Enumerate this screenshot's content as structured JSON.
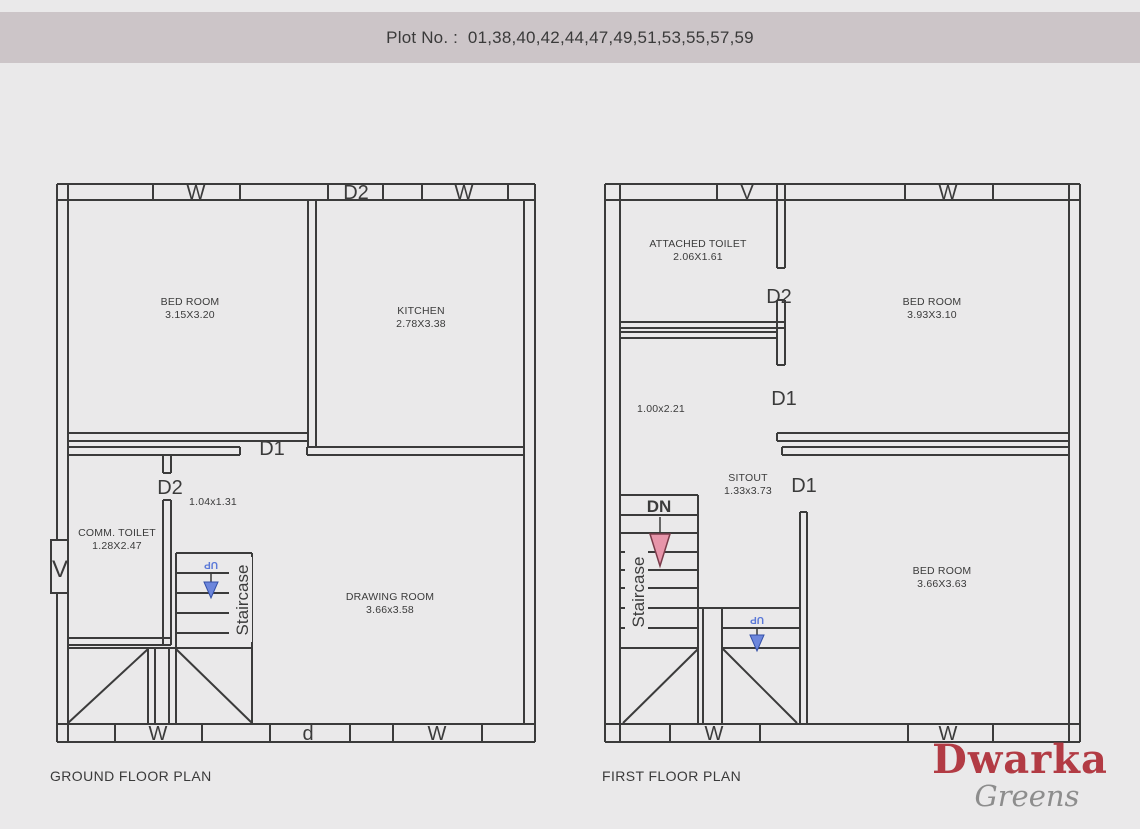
{
  "header": {
    "title": "Plot No. :  01,38,40,42,44,47,49,51,53,55,57,59"
  },
  "colors": {
    "background": "#eae9ea",
    "header_bar": "#ccc5c8",
    "wall_line": "#3b3b3b",
    "up_arrow_blue": "#5b79d8",
    "dn_arrow_pink": "#e795aa",
    "logo_red": "#b23b44",
    "logo_gray": "#8d8d8d"
  },
  "ground_floor": {
    "title": "GROUND FLOOR PLAN",
    "top_openings": [
      "W",
      "D2",
      "W"
    ],
    "bottom_openings": [
      "W",
      "d",
      "W"
    ],
    "left_opening": "V",
    "door_d1": "D1",
    "door_d2": "D2",
    "passage_dim": "1.04x1.31",
    "rooms": {
      "bedroom": {
        "name": "BED ROOM",
        "dim": "3.15X3.20"
      },
      "kitchen": {
        "name": "KITCHEN",
        "dim": "2.78X3.38"
      },
      "toilet": {
        "name": "COMM. TOILET",
        "dim": "1.28X2.47"
      },
      "drawing": {
        "name": "DRAWING ROOM",
        "dim": "3.66x3.58"
      }
    },
    "staircase": {
      "label": "Staircase",
      "up": "UP"
    }
  },
  "first_floor": {
    "title": "FIRST FLOOR PLAN",
    "top_openings": [
      "V",
      "W"
    ],
    "bottom_openings": [
      "W",
      "W"
    ],
    "door_d2": "D2",
    "door_d1_upper": "D1",
    "door_d1_lower": "D1",
    "passage_dim": "1.00x2.21",
    "rooms": {
      "toilet": {
        "name": "ATTACHED TOILET",
        "dim": "2.06X1.61"
      },
      "bedroom_top": {
        "name": "BED ROOM",
        "dim": "3.93X3.10"
      },
      "sitout": {
        "name": "SITOUT",
        "dim": "1.33x3.73"
      },
      "bedroom_bottom": {
        "name": "BED ROOM",
        "dim": "3.66X3.63"
      }
    },
    "staircase": {
      "label": "Staircase",
      "dn": "DN",
      "up": "UP"
    }
  },
  "logo": {
    "brand": "Dwarka",
    "sub": "Greens"
  }
}
